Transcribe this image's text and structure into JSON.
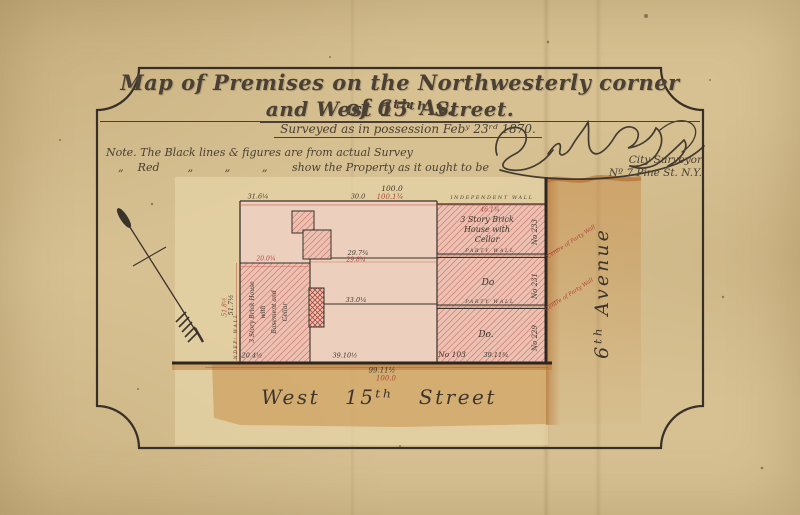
{
  "header": {
    "title_line1": "Map of Premises on the Northwesterly corner of 6ᵗʰ Av.",
    "title_line2": "and West 15ᵗʰ Street.",
    "surveyed_line": "Surveyed  as in possession  Febʸ 23ʳᵈ 1870.",
    "note_line1": "Note. The Black lines & figures are from actual Survey",
    "note_line2": "„    Red        „         „         „       show the Property as it ought to be"
  },
  "surveyor": {
    "signature": "Edwᵈ Byl",
    "title": "City Surveyor",
    "address": "Nº 7 Pine St. N.Y."
  },
  "map": {
    "streets": {
      "bottom": "West 15ᵗʰ Street",
      "right": "6ᵗʰ Avenue"
    },
    "walls": {
      "independent": "INDEPENDENT WALL",
      "party": "PARTY WALL",
      "independent_left": "INDEPᵗ WALL",
      "centre_of_party": "Centre of Party Wall"
    },
    "houses": [
      {
        "no": "No 233",
        "lines": [
          "3 Story Brick",
          "House with",
          "Cellar"
        ]
      },
      {
        "no": "No 231",
        "label": "Do"
      },
      {
        "no": "No 229",
        "label": "Do."
      },
      {
        "no": "No 103"
      }
    ],
    "strip_house": {
      "lines": [
        "3 Story Brick House",
        "with",
        "Basement and",
        "Cellar"
      ]
    },
    "dims": {
      "top_total_black": "100.0",
      "top_total_red": "100.1¾",
      "top_seg_left": "31.6¼",
      "top_seg_mid": "30.0",
      "right_house_front": "46.1¾",
      "mid_black": "29.7¾",
      "mid_red": "29.8¾",
      "mid_lower": "33.0¼",
      "strip_top": "20.0¾",
      "strip_bottom": "20.4½",
      "bottom_seg_mid": "39.10½",
      "bottom_seg_right": "39.11¾",
      "bottom_total_black": "99.11½",
      "bottom_total_red": "100.0",
      "left_side_black": "51.7½",
      "left_side_red": "51.8½"
    }
  }
}
